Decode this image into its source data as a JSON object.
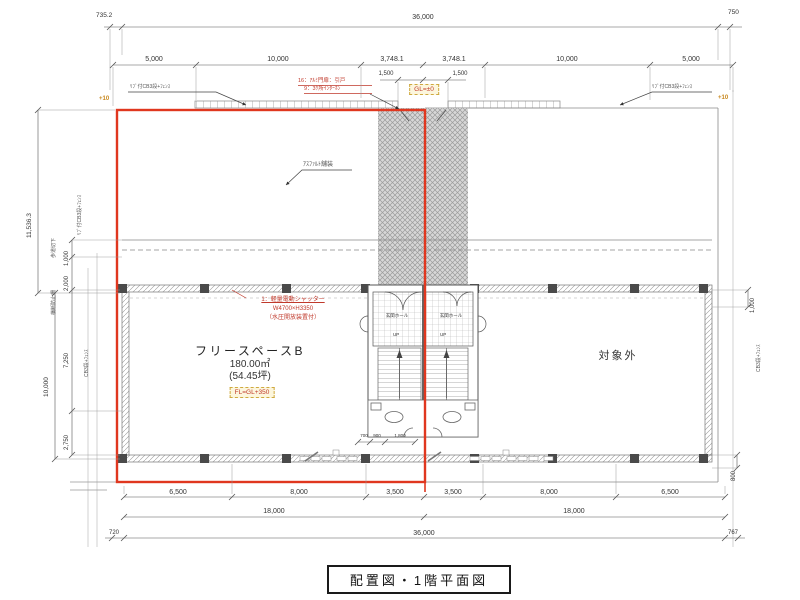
{
  "title_block": {
    "title": "配置図・1階平面図"
  },
  "colors": {
    "outline_red": "#e0371f",
    "note_red": "#c0392b",
    "level_orange": "#c8871c"
  },
  "dims_top": {
    "left_offset": "735.2",
    "total": "36,000",
    "right_offset": "750",
    "segments": [
      "5,000",
      "10,000",
      "3,748.1",
      "3,748.1",
      "10,000",
      "5,000"
    ],
    "gates": [
      "1,500",
      "1,500"
    ]
  },
  "dims_bottom": {
    "segments": [
      "6,500",
      "8,000",
      "3,500",
      "3,500",
      "8,000",
      "6,500"
    ],
    "halves": [
      "18,000",
      "18,000"
    ],
    "total": "36,000",
    "left_offset": "720",
    "right_offset": "767"
  },
  "dims_left": {
    "upper": "11,536.3",
    "overall": "10,000",
    "chain": [
      "1,000",
      "2,000",
      "7,250",
      "2,750"
    ]
  },
  "dims_right": {
    "upper": "1,000",
    "lower": "800"
  },
  "dims_center": [
    "700",
    "900",
    "1,800"
  ],
  "levels": {
    "gl": "GL=±0",
    "fl": "FL=GL+350",
    "left": "+10",
    "right": "+10"
  },
  "notes": {
    "gate_line1": "16：ｱﾙﾐ門扉：引戸",
    "gate_line2": "9：3ｹ所ｲﾝﾀｰﾎﾝ",
    "shutter_line1": "1：軽量電動シャッター",
    "shutter_line2": "W4700×H3350",
    "shutter_line3": "（水圧開放装置付）",
    "asphalt": "ｱｽﾌｧﾙﾄ舗装"
  },
  "rooms": {
    "free_space_name": "フリースペースB",
    "free_space_area": "180.00㎡",
    "free_space_tsubo": "(54.45坪)",
    "excluded": "対象外",
    "entrance_left": "玄関ホール",
    "entrance_right": "玄関ホール",
    "up_left": "UP",
    "up_right": "UP"
  },
  "fences": {
    "top_left": "ﾘﾌﾞ付CB3段+ﾌｪﾝｽ",
    "top_right": "ﾘﾌﾞ付CB3段+ﾌｪﾝｽ",
    "left_upper": "ﾘﾌﾞ付CB3段+ﾌｪﾝｽ",
    "left_lower": "CB3段+ﾌｪﾝｽ",
    "right": "CB3段+ﾌｪﾝｽ",
    "sidewalk": "歩道切下",
    "barrier": "横断防止柵"
  }
}
